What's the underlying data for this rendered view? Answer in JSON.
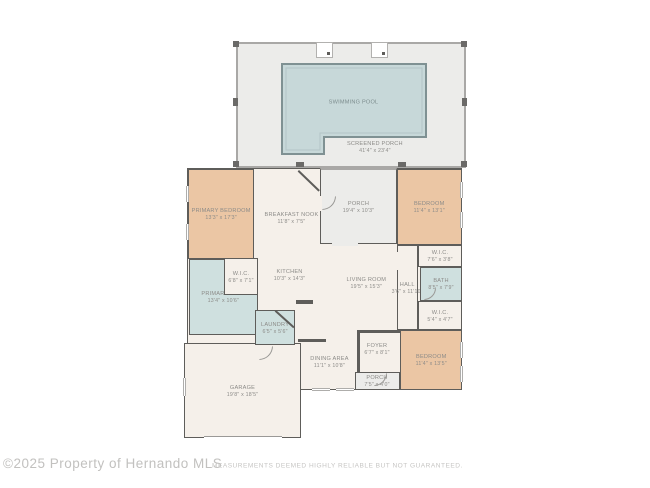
{
  "colors": {
    "wall": "#5e5d5a",
    "bedroom_fill": "#ebc6a4",
    "bath_fill": "#cfe0df",
    "pool_fill": "#c7d8d9",
    "floor_fill": "#f5f0ea",
    "porch_fill": "#ececea",
    "label_gray": "#8c8b88",
    "footer_gray": "#c2c1bf"
  },
  "plan": {
    "pool": {
      "label": "SWIMMING POOL"
    },
    "screened_porch": {
      "label": "SCREENED PORCH",
      "dims": "41'4\" x 23'4\""
    },
    "porch_top": {
      "label": "PORCH",
      "dims": "19'4\" x 10'3\""
    },
    "primary_bedroom": {
      "label": "PRIMARY BEDROOM",
      "dims": "13'3\" x 17'3\""
    },
    "breakfast_nook": {
      "label": "BREAKFAST NOOK",
      "dims": "11'8\" x 7'5\""
    },
    "bedroom_top": {
      "label": "BEDROOM",
      "dims": "11'4\" x 13'1\""
    },
    "wic_left": {
      "label": "W.I.C.",
      "dims": "6'8\" x 7'1\""
    },
    "kitchen": {
      "label": "KITCHEN",
      "dims": "10'3\" x 14'3\""
    },
    "living_room": {
      "label": "LIVING ROOM",
      "dims": "19'5\" x 15'3\""
    },
    "wic_top_right": {
      "label": "W.I.C.",
      "dims": "7'6\" x 3'8\""
    },
    "bath": {
      "label": "BATH",
      "dims": "8'5\" x 7'9\""
    },
    "hall": {
      "label": "HALL",
      "dims": "3'6\" x 11'10\""
    },
    "wic_lower_right": {
      "label": "W.I.C.",
      "dims": "5'4\" x 4'7\""
    },
    "primary_bath": {
      "label": "PRIMARY BATH",
      "dims": "13'4\" x 10'6\""
    },
    "laundry": {
      "label": "LAUNDRY",
      "dims": "6'5\" x 5'6\""
    },
    "dining": {
      "label": "DINING AREA",
      "dims": "11'1\" x 10'8\""
    },
    "foyer": {
      "label": "FOYER",
      "dims": "6'7\" x 8'1\""
    },
    "porch_bottom": {
      "label": "PORCH",
      "dims": "7'5\" x 4'0\""
    },
    "bedroom_bottom": {
      "label": "BEDROOM",
      "dims": "11'4\" x 13'5\""
    },
    "garage": {
      "label": "GARAGE",
      "dims": "19'8\" x 18'5\""
    }
  },
  "footer": {
    "copyright": "©2025 Property of Hernando MLS",
    "disclaimer": "MEASUREMENTS DEEMED HIGHLY RELIABLE BUT NOT GUARANTEED."
  }
}
